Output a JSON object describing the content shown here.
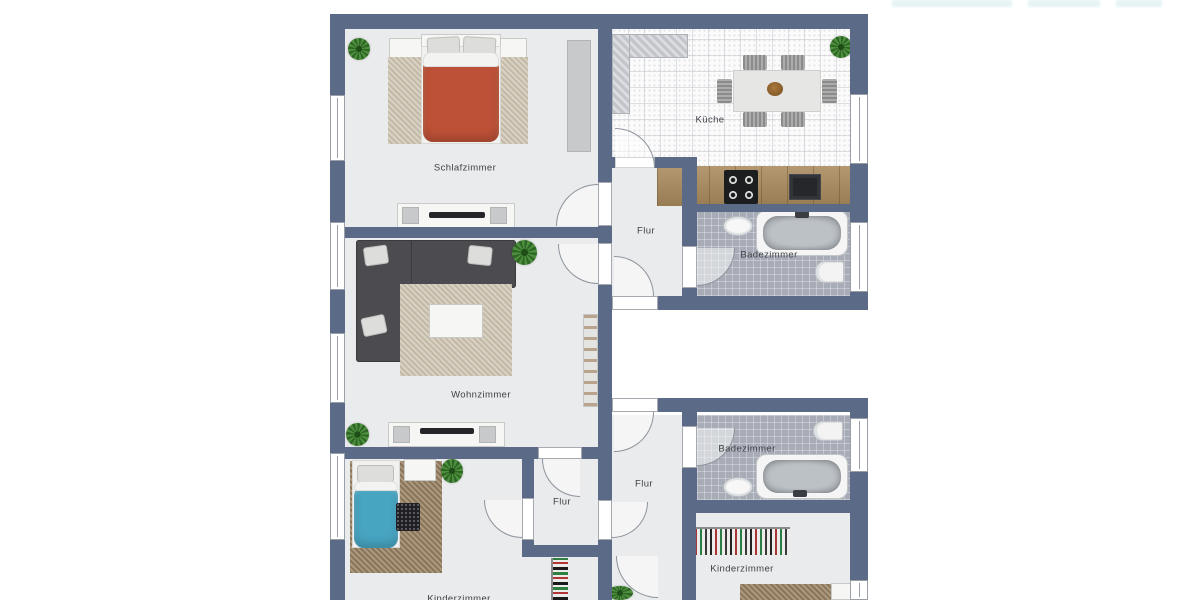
{
  "title": "Grundriss Wohnung (floor plan)",
  "colors": {
    "wall": "#5b6a86",
    "room_floor": "#eaebec",
    "kitchen_floor": "#fbfbfb",
    "bath_floor": "#a7acb7",
    "counter_wood": "#aa8d61",
    "duvet_red": "#bd5137",
    "duvet_blue": "#47a5c2",
    "sofa": "#4c4c50",
    "label_text": "#3e4246"
  },
  "rooms": [
    "Schlafzimmer",
    "Küche",
    "Flur",
    "Badezimmer",
    "Wohnzimmer",
    "Badezimmer",
    "Flur",
    "Flur",
    "Kinderzimmer",
    "Kinderzimmer"
  ],
  "plan": {
    "elements": [
      {
        "t": "floor",
        "n": "schlafzimmer-floor",
        "x": 345,
        "y": 28,
        "w": 253,
        "h": 200
      },
      {
        "t": "kfloor",
        "n": "kueche-floor",
        "x": 612,
        "y": 28,
        "w": 238,
        "h": 140
      },
      {
        "t": "floor",
        "n": "flur-upper-floor",
        "x": 612,
        "y": 168,
        "w": 70,
        "h": 128
      },
      {
        "t": "bfloor",
        "n": "badezimmer-upper-floor",
        "x": 697,
        "y": 210,
        "w": 153,
        "h": 86
      },
      {
        "t": "floor",
        "n": "wohnzimmer-floor",
        "x": 345,
        "y": 238,
        "w": 253,
        "h": 209
      },
      {
        "t": "floor",
        "n": "kinderzimmer2-floor",
        "x": 345,
        "y": 459,
        "w": 253,
        "h": 141
      },
      {
        "t": "floor",
        "n": "flur-lower-floor",
        "x": 612,
        "y": 415,
        "w": 70,
        "h": 185
      },
      {
        "t": "bfloor",
        "n": "badezimmer-lower-floor",
        "x": 697,
        "y": 415,
        "w": 153,
        "h": 85
      },
      {
        "t": "floor",
        "n": "kinderzimmer-floor",
        "x": 696,
        "y": 513,
        "w": 154,
        "h": 87
      },
      {
        "t": "plant",
        "n": "plant",
        "x": 348,
        "y": 38,
        "w": 22,
        "h": 22
      },
      {
        "t": "graybox",
        "n": "wardrobe",
        "x": 567,
        "y": 40,
        "w": 24,
        "h": 112
      },
      {
        "t": "white",
        "n": "nightstand",
        "x": 389,
        "y": 38,
        "w": 33,
        "h": 20
      },
      {
        "t": "white",
        "n": "nightstand",
        "x": 497,
        "y": 38,
        "w": 30,
        "h": 20
      },
      {
        "t": "rug",
        "n": "rug",
        "x": 388,
        "y": 57,
        "w": 140,
        "h": 87
      },
      {
        "t": "white",
        "n": "bed-headboard",
        "x": 421,
        "y": 34,
        "w": 80,
        "h": 13
      },
      {
        "t": "sheet",
        "n": "bed-sheet",
        "x": 421,
        "y": 46,
        "w": 80,
        "h": 98
      },
      {
        "t": "pillow",
        "n": "pillow",
        "x": 427,
        "y": 37,
        "w": 33,
        "h": 17,
        "rot": -3
      },
      {
        "t": "pillow",
        "n": "pillow",
        "x": 463,
        "y": 37,
        "w": 33,
        "h": 17,
        "rot": 3
      },
      {
        "t": "duvet",
        "n": "duvet-double-bed",
        "x": 423,
        "y": 58,
        "w": 76,
        "h": 84,
        "bg": "#bd5137"
      },
      {
        "t": "fold",
        "n": "duvet-fold",
        "x": 423,
        "y": 52,
        "w": 76,
        "h": 15
      },
      {
        "t": "white",
        "n": "sideboard",
        "x": 397,
        "y": 203,
        "w": 118,
        "h": 25
      },
      {
        "t": "graybox",
        "n": "sideboard-speaker",
        "x": 402,
        "y": 207,
        "w": 17,
        "h": 17
      },
      {
        "t": "graybox",
        "n": "sideboard-speaker",
        "x": 490,
        "y": 207,
        "w": 17,
        "h": 17
      },
      {
        "t": "tv",
        "n": "tv",
        "x": 429,
        "y": 212,
        "w": 56,
        "h": 6
      },
      {
        "t": "plant",
        "n": "plant",
        "x": 830,
        "y": 36,
        "w": 22,
        "h": 22
      },
      {
        "t": "hatch",
        "n": "kitchen-counter-top",
        "x": 612,
        "y": 34,
        "w": 76,
        "h": 24
      },
      {
        "t": "hatch",
        "n": "kitchen-counter-left",
        "x": 612,
        "y": 34,
        "w": 18,
        "h": 80
      },
      {
        "t": "table",
        "n": "dining-table",
        "x": 733,
        "y": 70,
        "w": 88,
        "h": 42
      },
      {
        "t": "chair",
        "n": "chair",
        "x": 743,
        "y": 55,
        "w": 24,
        "h": 15
      },
      {
        "t": "chair",
        "n": "chair",
        "x": 781,
        "y": 55,
        "w": 24,
        "h": 15
      },
      {
        "t": "chair",
        "n": "chair",
        "x": 743,
        "y": 112,
        "w": 24,
        "h": 15
      },
      {
        "t": "chair",
        "n": "chair",
        "x": 781,
        "y": 112,
        "w": 24,
        "h": 15
      },
      {
        "t": "chair",
        "n": "chair",
        "x": 717,
        "y": 79,
        "w": 15,
        "h": 24
      },
      {
        "t": "chair",
        "n": "chair",
        "x": 822,
        "y": 79,
        "w": 15,
        "h": 24
      },
      {
        "t": "bowl",
        "n": "fruit-bowl",
        "x": 767,
        "y": 82,
        "w": 16,
        "h": 14
      },
      {
        "t": "wood",
        "n": "kitchen-counter",
        "x": 657,
        "y": 166,
        "w": 193,
        "h": 40
      },
      {
        "t": "stove",
        "n": "stove",
        "x": 724,
        "y": 170,
        "w": 34,
        "h": 34
      },
      {
        "t": "ksink",
        "n": "kitchen-sink",
        "x": 789,
        "y": 174,
        "w": 32,
        "h": 26
      },
      {
        "t": "basin",
        "n": "bathroom-sink",
        "x": 723,
        "y": 216,
        "w": 30,
        "h": 20
      },
      {
        "t": "tub",
        "n": "bathtub",
        "x": 756,
        "y": 210,
        "w": 92,
        "h": 46
      },
      {
        "t": "tubin",
        "n": "bathtub-inner",
        "x": 763,
        "y": 216,
        "w": 78,
        "h": 34
      },
      {
        "t": "faucet",
        "n": "faucet",
        "x": 795,
        "y": 211,
        "w": 14,
        "h": 7
      },
      {
        "t": "toilet",
        "n": "toilet",
        "x": 815,
        "y": 261,
        "w": 29,
        "h": 22
      },
      {
        "t": "sofa",
        "n": "sofa",
        "x": 356,
        "y": 240,
        "w": 160,
        "h": 48
      },
      {
        "t": "sofa",
        "n": "sofa",
        "x": 356,
        "y": 240,
        "w": 56,
        "h": 122
      },
      {
        "t": "pillow",
        "n": "pillow",
        "x": 364,
        "y": 246,
        "w": 24,
        "h": 19,
        "rot": -8
      },
      {
        "t": "pillow",
        "n": "pillow",
        "x": 468,
        "y": 246,
        "w": 24,
        "h": 19,
        "rot": 6
      },
      {
        "t": "pillow",
        "n": "pillow",
        "x": 362,
        "y": 316,
        "w": 24,
        "h": 19,
        "rot": -12
      },
      {
        "t": "rug",
        "n": "rug",
        "x": 400,
        "y": 284,
        "w": 112,
        "h": 92
      },
      {
        "t": "white",
        "n": "coffee-table",
        "x": 429,
        "y": 304,
        "w": 54,
        "h": 34
      },
      {
        "t": "plant",
        "n": "plant",
        "x": 512,
        "y": 240,
        "w": 25,
        "h": 25
      },
      {
        "t": "plant",
        "n": "plant",
        "x": 346,
        "y": 423,
        "w": 23,
        "h": 23
      },
      {
        "t": "white",
        "n": "sideboard",
        "x": 388,
        "y": 422,
        "w": 117,
        "h": 25
      },
      {
        "t": "graybox",
        "n": "sideboard-speaker",
        "x": 393,
        "y": 426,
        "w": 17,
        "h": 17
      },
      {
        "t": "graybox",
        "n": "sideboard-speaker",
        "x": 479,
        "y": 426,
        "w": 17,
        "h": 17
      },
      {
        "t": "tv",
        "n": "tv",
        "x": 420,
        "y": 428,
        "w": 54,
        "h": 6
      },
      {
        "t": "shelf",
        "n": "shelf",
        "x": 583,
        "y": 314,
        "w": 15,
        "h": 93
      },
      {
        "t": "rugb",
        "n": "rug",
        "x": 350,
        "y": 461,
        "w": 92,
        "h": 112
      },
      {
        "t": "white",
        "n": "bed-headboard",
        "x": 352,
        "y": 460,
        "w": 48,
        "h": 11
      },
      {
        "t": "sheet",
        "n": "bed-sheet",
        "x": 352,
        "y": 460,
        "w": 48,
        "h": 88
      },
      {
        "t": "pillow",
        "n": "pillow",
        "x": 357,
        "y": 465,
        "w": 37,
        "h": 17
      },
      {
        "t": "duvet",
        "n": "duvet-single-bed",
        "x": 354,
        "y": 486,
        "w": 44,
        "h": 62,
        "bg": "#47a5c2"
      },
      {
        "t": "fold",
        "n": "duvet-fold",
        "x": 354,
        "y": 481,
        "w": 44,
        "h": 10
      },
      {
        "t": "white",
        "n": "desk",
        "x": 404,
        "y": 459,
        "w": 32,
        "h": 22
      },
      {
        "t": "mat",
        "n": "dark-mat",
        "x": 396,
        "y": 503,
        "w": 24,
        "h": 28
      },
      {
        "t": "plant",
        "n": "plant",
        "x": 441,
        "y": 459,
        "w": 22,
        "h": 24
      },
      {
        "t": "clothesv",
        "n": "clothes-rack",
        "x": 551,
        "y": 558,
        "w": 17,
        "h": 42
      },
      {
        "t": "plant",
        "n": "plant",
        "x": 607,
        "y": 586,
        "w": 26,
        "h": 14
      },
      {
        "t": "toilet",
        "n": "toilet",
        "x": 813,
        "y": 421,
        "w": 30,
        "h": 20
      },
      {
        "t": "tub",
        "n": "bathtub",
        "x": 756,
        "y": 454,
        "w": 92,
        "h": 45
      },
      {
        "t": "tubin",
        "n": "bathtub-inner",
        "x": 763,
        "y": 460,
        "w": 78,
        "h": 33
      },
      {
        "t": "faucet",
        "n": "faucet",
        "x": 793,
        "y": 490,
        "w": 14,
        "h": 7
      },
      {
        "t": "basin",
        "n": "bathroom-sink",
        "x": 723,
        "y": 477,
        "w": 30,
        "h": 20
      },
      {
        "t": "clothesh",
        "n": "wardrobe-clothes",
        "x": 690,
        "y": 527,
        "w": 100,
        "h": 28
      },
      {
        "t": "rugb",
        "n": "rug",
        "x": 740,
        "y": 584,
        "w": 93,
        "h": 16
      },
      {
        "t": "white",
        "n": "desk",
        "x": 831,
        "y": 583,
        "w": 22,
        "h": 17
      },
      {
        "t": "wall",
        "n": "wall",
        "x": 330,
        "y": 14,
        "w": 538,
        "h": 15
      },
      {
        "t": "wall",
        "n": "wall",
        "x": 330,
        "y": 14,
        "w": 15,
        "h": 586
      },
      {
        "t": "wall",
        "n": "wall",
        "x": 598,
        "y": 14,
        "w": 14,
        "h": 586
      },
      {
        "t": "wall",
        "n": "wall",
        "x": 850,
        "y": 14,
        "w": 18,
        "h": 296
      },
      {
        "t": "wall",
        "n": "wall",
        "x": 850,
        "y": 398,
        "w": 18,
        "h": 202
      },
      {
        "t": "wall",
        "n": "wall",
        "x": 345,
        "y": 227,
        "w": 253,
        "h": 11
      },
      {
        "t": "wall",
        "n": "wall",
        "x": 612,
        "y": 157,
        "w": 70,
        "h": 11
      },
      {
        "t": "wall",
        "n": "wall",
        "x": 682,
        "y": 204,
        "w": 168,
        "h": 8
      },
      {
        "t": "wall",
        "n": "wall",
        "x": 682,
        "y": 157,
        "w": 15,
        "h": 147
      },
      {
        "t": "wall",
        "n": "wall",
        "x": 598,
        "y": 296,
        "w": 270,
        "h": 14
      },
      {
        "t": "wall",
        "n": "wall",
        "x": 598,
        "y": 398,
        "w": 270,
        "h": 14
      },
      {
        "t": "wall",
        "n": "wall",
        "x": 682,
        "y": 412,
        "w": 15,
        "h": 88
      },
      {
        "t": "wall",
        "n": "wall",
        "x": 682,
        "y": 500,
        "w": 186,
        "h": 13
      },
      {
        "t": "wall",
        "n": "wall",
        "x": 682,
        "y": 513,
        "w": 14,
        "h": 87
      },
      {
        "t": "wall",
        "n": "wall",
        "x": 345,
        "y": 447,
        "w": 253,
        "h": 12
      },
      {
        "t": "wall",
        "n": "wall",
        "x": 522,
        "y": 447,
        "w": 12,
        "h": 98
      },
      {
        "t": "wall",
        "n": "wall",
        "x": 522,
        "y": 545,
        "w": 90,
        "h": 12
      },
      {
        "t": "window",
        "n": "window",
        "x": 330,
        "y": 95,
        "w": 15,
        "h": 66
      },
      {
        "t": "window",
        "n": "window",
        "x": 330,
        "y": 222,
        "w": 15,
        "h": 68
      },
      {
        "t": "window",
        "n": "window",
        "x": 330,
        "y": 333,
        "w": 15,
        "h": 70
      },
      {
        "t": "window",
        "n": "window",
        "x": 330,
        "y": 453,
        "w": 15,
        "h": 87
      },
      {
        "t": "window",
        "n": "window",
        "x": 850,
        "y": 94,
        "w": 18,
        "h": 70
      },
      {
        "t": "window",
        "n": "window",
        "x": 850,
        "y": 222,
        "w": 18,
        "h": 70
      },
      {
        "t": "window",
        "n": "window",
        "x": 850,
        "y": 418,
        "w": 18,
        "h": 54
      },
      {
        "t": "window",
        "n": "window",
        "x": 850,
        "y": 580,
        "w": 18,
        "h": 20
      },
      {
        "t": "jamb",
        "n": "door-opening",
        "x": 598,
        "y": 182,
        "w": 14,
        "h": 44
      },
      {
        "t": "jamb",
        "n": "door-opening",
        "x": 598,
        "y": 243,
        "w": 14,
        "h": 42
      },
      {
        "t": "jamb",
        "n": "door-opening",
        "x": 615,
        "y": 157,
        "w": 40,
        "h": 11
      },
      {
        "t": "jamb",
        "n": "door-opening",
        "x": 682,
        "y": 246,
        "w": 15,
        "h": 42
      },
      {
        "t": "jamb",
        "n": "door-opening",
        "x": 612,
        "y": 296,
        "w": 46,
        "h": 14
      },
      {
        "t": "jamb",
        "n": "door-opening",
        "x": 612,
        "y": 398,
        "w": 46,
        "h": 14
      },
      {
        "t": "jamb",
        "n": "door-opening",
        "x": 682,
        "y": 426,
        "w": 15,
        "h": 42
      },
      {
        "t": "jamb",
        "n": "door-opening",
        "x": 538,
        "y": 447,
        "w": 44,
        "h": 12
      },
      {
        "t": "jamb",
        "n": "door-opening",
        "x": 522,
        "y": 498,
        "w": 12,
        "h": 42
      },
      {
        "t": "jamb",
        "n": "door-opening",
        "x": 598,
        "y": 500,
        "w": 14,
        "h": 40
      },
      {
        "t": "door",
        "n": "door-swing",
        "x": 556,
        "y": 184,
        "w": 42,
        "h": 42,
        "r": "tl"
      },
      {
        "t": "door",
        "n": "door-swing",
        "x": 615,
        "y": 128,
        "w": 40,
        "h": 40,
        "r": "tr"
      },
      {
        "t": "door",
        "n": "door-swing",
        "x": 558,
        "y": 244,
        "w": 40,
        "h": 40,
        "r": "bl"
      },
      {
        "t": "door",
        "n": "door-swing",
        "x": 697,
        "y": 248,
        "w": 38,
        "h": 38,
        "r": "br"
      },
      {
        "t": "door",
        "n": "door-swing",
        "x": 614,
        "y": 256,
        "w": 40,
        "h": 40,
        "r": "tr"
      },
      {
        "t": "door",
        "n": "door-swing",
        "x": 614,
        "y": 412,
        "w": 40,
        "h": 40,
        "r": "br"
      },
      {
        "t": "door",
        "n": "door-swing",
        "x": 697,
        "y": 428,
        "w": 38,
        "h": 38,
        "r": "br"
      },
      {
        "t": "door",
        "n": "door-swing",
        "x": 542,
        "y": 459,
        "w": 38,
        "h": 38,
        "r": "bl"
      },
      {
        "t": "door",
        "n": "door-swing",
        "x": 484,
        "y": 500,
        "w": 38,
        "h": 38,
        "r": "bl"
      },
      {
        "t": "door",
        "n": "door-swing",
        "x": 612,
        "y": 502,
        "w": 36,
        "h": 36,
        "r": "br"
      },
      {
        "t": "door",
        "n": "door-swing",
        "x": 616,
        "y": 556,
        "w": 42,
        "h": 42,
        "r": "bl"
      },
      {
        "t": "label",
        "n": "room-label-schlafzimmer",
        "x": 465,
        "y": 168,
        "text": "Schlafzimmer"
      },
      {
        "t": "label",
        "n": "room-label-kueche",
        "x": 710,
        "y": 120,
        "text": "Küche"
      },
      {
        "t": "label",
        "n": "room-label-flur-upper",
        "x": 646,
        "y": 231,
        "text": "Flur"
      },
      {
        "t": "label",
        "n": "room-label-badezimmer-upper",
        "x": 769,
        "y": 255,
        "text": "Badezimmer"
      },
      {
        "t": "label",
        "n": "room-label-wohnzimmer",
        "x": 481,
        "y": 395,
        "text": "Wohnzimmer"
      },
      {
        "t": "label",
        "n": "room-label-badezimmer-lower",
        "x": 747,
        "y": 449,
        "text": "Badezimmer"
      },
      {
        "t": "label",
        "n": "room-label-flur-lower",
        "x": 644,
        "y": 484,
        "text": "Flur"
      },
      {
        "t": "label",
        "n": "room-label-flur-vestibule",
        "x": 562,
        "y": 502,
        "text": "Flur"
      },
      {
        "t": "label",
        "n": "room-label-kinderzimmer",
        "x": 742,
        "y": 569,
        "text": "Kinderzimmer"
      },
      {
        "t": "label",
        "n": "room-label-kinderzimmer-2",
        "x": 459,
        "y": 599,
        "text": "Kinderzimmer"
      },
      {
        "t": "wm",
        "n": "watermark",
        "x": 892,
        "y": 0,
        "w": 120,
        "h": 7
      },
      {
        "t": "wm",
        "n": "watermark",
        "x": 1028,
        "y": 0,
        "w": 72,
        "h": 7
      },
      {
        "t": "wm",
        "n": "watermark",
        "x": 1116,
        "y": 0,
        "w": 46,
        "h": 7
      }
    ]
  }
}
